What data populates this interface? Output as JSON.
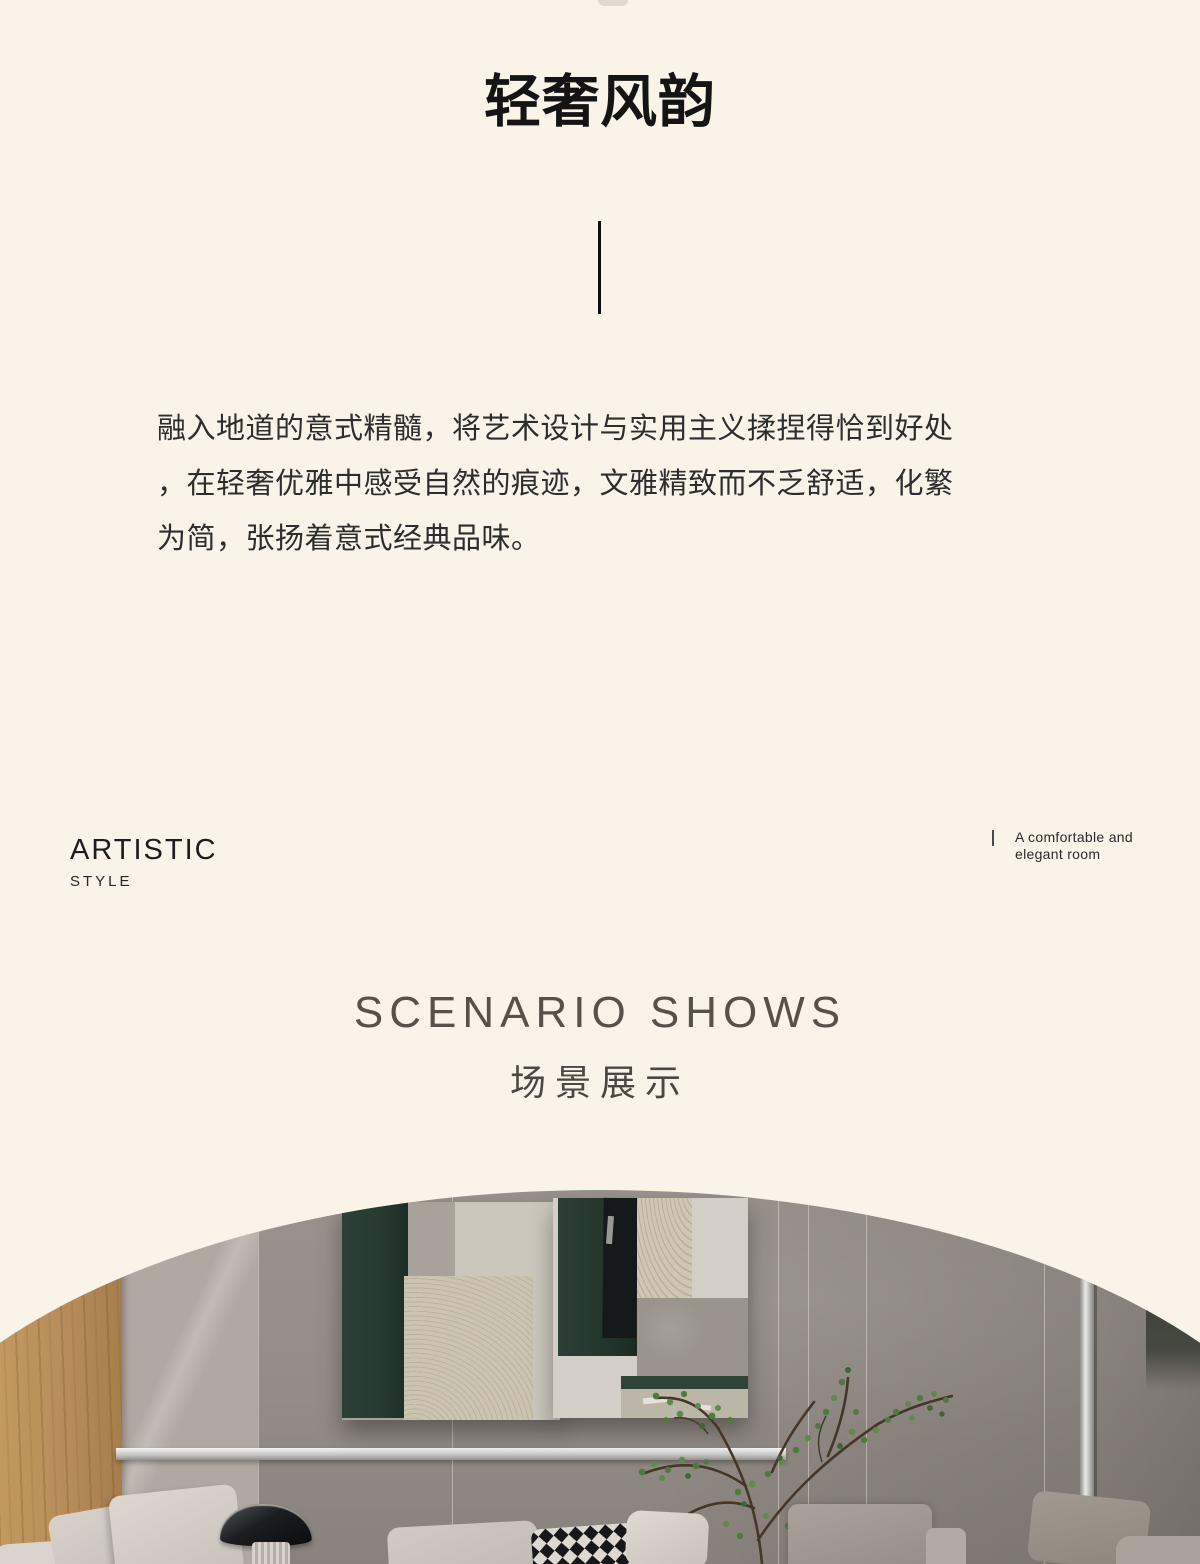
{
  "theme": {
    "background": "#faf3e8",
    "title_color": "#141414",
    "body_text_color": "#2d2d2d",
    "heading_gray": "#57514a",
    "art_green": "#263a30",
    "wood": "#b78c5a",
    "wall_gray": "#948c86"
  },
  "hero": {
    "title": "轻奢风韵"
  },
  "intro": {
    "lines": [
      "融入地道的意式精髓，将艺术设计与实用主义揉捏得恰到好处",
      "，在轻奢优雅中感受自然的痕迹，文雅精致而不乏舒适，化繁",
      "为简，张扬着意式经典品味。"
    ]
  },
  "artistic": {
    "title": "ARTISTIC",
    "subtitle": "STYLE"
  },
  "caption": {
    "line1": "A comfortable and",
    "line2": "elegant room"
  },
  "scenario": {
    "title_en": "SCENARIO SHOWS",
    "title_zh": "场景展示"
  }
}
